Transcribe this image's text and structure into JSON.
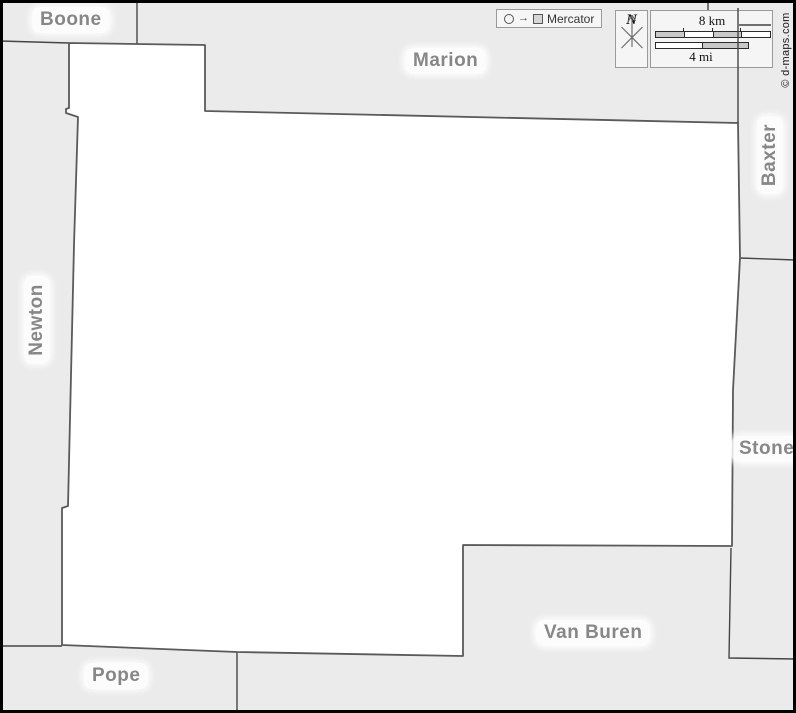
{
  "colors": {
    "background": "#ebebeb",
    "county_fill": "#ffffff",
    "county_border": "#5a5a5a",
    "neighbor_border": "#454545",
    "label_text": "#878787",
    "frame": "#000000",
    "scalebar_gray": "#c9c9c9"
  },
  "legend": {
    "projection": "Mercator"
  },
  "compass": {
    "north_label": "N"
  },
  "scalebar": {
    "km_label": "8 km",
    "mi_label": "4 mi"
  },
  "copyright": "© d-maps.com",
  "labels": {
    "boone": "Boone",
    "marion": "Marion",
    "baxter": "Baxter",
    "newton": "Newton",
    "stone": "Stone",
    "van_buren": "Van Buren",
    "pope": "Pope"
  }
}
